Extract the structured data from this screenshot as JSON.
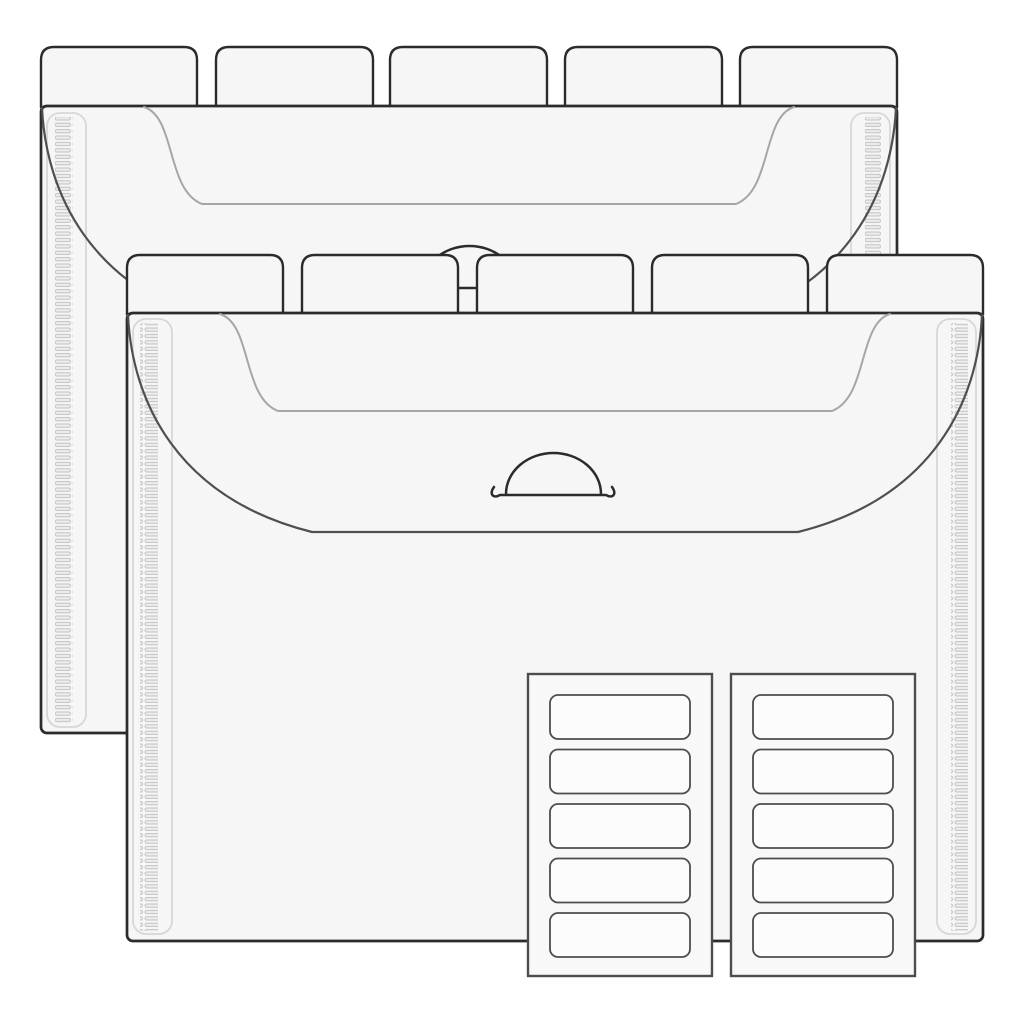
{
  "illustration": {
    "description": "Line drawing of two expanding file organizer folders with five top index tabs each, arched pull-cord flap closures, textured side gussets, and two sheets of five blank rectangular labels",
    "back_folder": {
      "tab_count": 5,
      "tabs_blank": true,
      "gusset_strips": 2,
      "closure": "arched cord handle"
    },
    "front_folder": {
      "tab_count": 5,
      "tabs_blank": true,
      "gusset_strips": 2,
      "closure": "arched cord handle"
    },
    "label_sheets": {
      "sheet_count": 2,
      "labels_per_sheet": 5,
      "label_text": ""
    },
    "colors": {
      "background": "#ffffff",
      "folder_fill": "#f6f6f6",
      "outline": "#2b2b2b",
      "flap_line": "#4f4f4f",
      "inner_line": "#a6a6a6",
      "gusset_line": "#d7d7d7",
      "gusset_bar_fill": "#ededed",
      "gusset_bar_stroke": "#c0c0c0",
      "sheet_fill": "#f8f8f8",
      "sheet_stroke": "#4d4d4d",
      "label_fill": "#fcfcfc"
    }
  }
}
